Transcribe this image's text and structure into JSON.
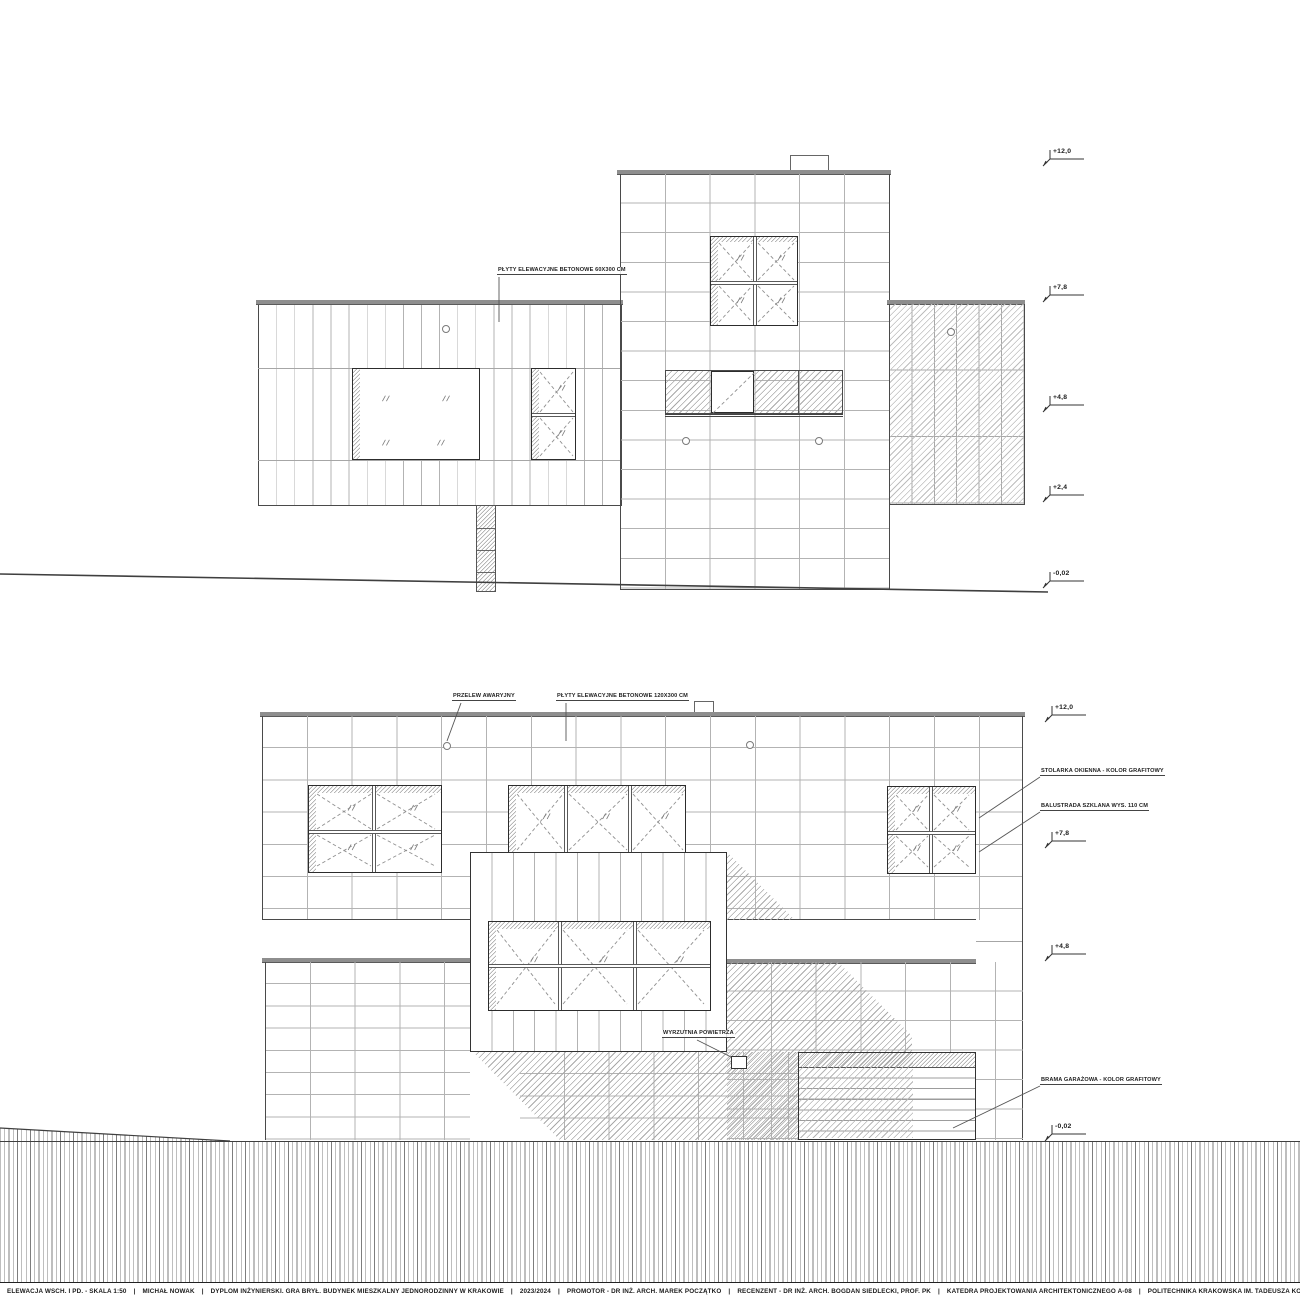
{
  "colors": {
    "outline": "#3d3d3d",
    "grid_line": "#b3b3b3",
    "coping": "#8e8e8e",
    "hatch": "#a8a8a8"
  },
  "title_bar": {
    "separator": "|",
    "items": [
      "ELEWACJA WSCH. I PD. - SKALA 1:50",
      "MICHAŁ NOWAK",
      "DYPLOM INŻYNIERSKI. GRA BRYŁ. BUDYNEK MIESZKALNY JEDNORODZINNY W KRAKOWIE",
      "2023/2024",
      "PROMOTOR - DR INŻ. ARCH. MAREK POCZĄTKO",
      "RECENZENT - DR INŻ. ARCH. BOGDAN SIEDLECKI, PROF. PK",
      "KATEDRA PROJEKTOWANIA ARCHITEKTONICZNEGO A-08",
      "POLITECHNIKA KRAKOWSKA IM. TADEUSZA KOŚCIUSZKI"
    ]
  },
  "top_drawing": {
    "levels": [
      {
        "label": "+12,0"
      },
      {
        "label": "+7,8"
      },
      {
        "label": "+4,8"
      },
      {
        "label": "+2,4"
      },
      {
        "label": "-0,02"
      }
    ],
    "annotations": [
      {
        "text": "PŁYTY ELEWACYJNE BETONOWE 60X300 CM"
      }
    ]
  },
  "bottom_drawing": {
    "levels": [
      {
        "label": "+12,0"
      },
      {
        "label": "+7,8"
      },
      {
        "label": "+4,8"
      },
      {
        "label": "-0,02"
      }
    ],
    "annotations": [
      {
        "text": "PRZELEW AWARYJNY"
      },
      {
        "text": "PŁYTY ELEWACYJNE BETONOWE 120X300 CM"
      },
      {
        "text": "STOLARKA OKIENNA - KOLOR GRAFITOWY"
      },
      {
        "text": "BALUSTRADA SZKLANA WYS. 110 CM"
      },
      {
        "text": "WYRZUTNIA POWIETRZA"
      },
      {
        "text": "BRAMA GARAŻOWA - KOLOR GRAFITOWY"
      }
    ]
  }
}
